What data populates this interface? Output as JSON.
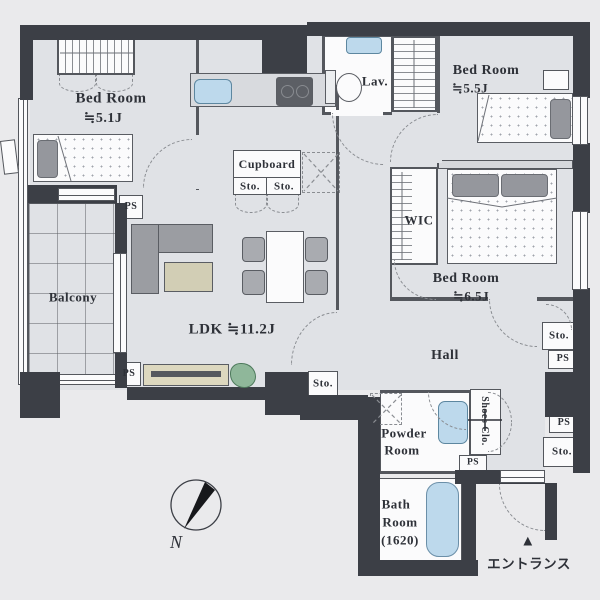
{
  "plan": {
    "bedroom_small": {
      "name": "Bed Room",
      "size": "≒5.1J"
    },
    "bedroom_mid": {
      "name": "Bed Room",
      "size": "≒5.5J"
    },
    "bedroom_large": {
      "name": "Bed Room",
      "size": "≒6.5J"
    },
    "ldk": {
      "name": "LDK ≒11.2J"
    },
    "balcony": {
      "name": "Balcony"
    },
    "hall": {
      "name": "Hall"
    },
    "lav": {
      "name": "Lav."
    },
    "wic": {
      "name": "WIC"
    },
    "cupboard": {
      "name": "Cupboard"
    },
    "powder": {
      "line1": "Powder",
      "line2": "Room"
    },
    "bath": {
      "line1": "Bath",
      "line2": "Room",
      "line3": "(1620)"
    },
    "shoes_closet": {
      "name": "Shoes Clo."
    },
    "storage_label": "Sto.",
    "pipe_space_label": "PS",
    "entrance": {
      "label": "エントランス",
      "marker": "▲"
    },
    "compass": {
      "north": "N"
    }
  },
  "colors": {
    "wall": "#3c3f46",
    "floor": "#e0e2e6",
    "white": "#fbfbfc",
    "water": "#bdd9ec",
    "ink": "#2e3138",
    "line": "#54575d",
    "dash": "#8a8d92",
    "sofa": "#9b9da2",
    "rug": "#d2ceb5",
    "tv": "#ddd8bf",
    "plant": "#8fb79a",
    "counter": "#d8dade",
    "pillow": "#95979d",
    "outside": "#eaeaec"
  }
}
